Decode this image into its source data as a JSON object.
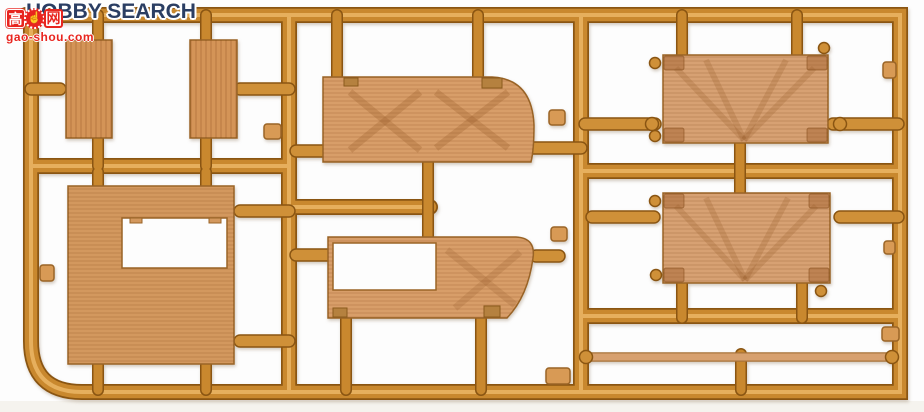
{
  "photo_subject": "injection-molded model kit sprue with tan wood-grain panel parts on an orange runner frame",
  "overlay_logo": {
    "text": "HOBBY SEARCH"
  },
  "watermark": {
    "cn_first": "高",
    "thumb_icon": "☝",
    "cn_last": "网",
    "site": "gao-shou.com"
  },
  "colors": {
    "background": "#fdfdfd",
    "runner_fill": "#c9882e",
    "runner_outline": "#8a5512",
    "runner_highlight": "#eeb969",
    "panel_small": "#d49457",
    "panel_large_left": "#d3985e",
    "panel_middle": "#d89e69",
    "panel_right": "#d7a173",
    "panel_outline": "#9a6426",
    "watermark_red": "#e8251f",
    "logo_navy": "#2b3e63"
  }
}
